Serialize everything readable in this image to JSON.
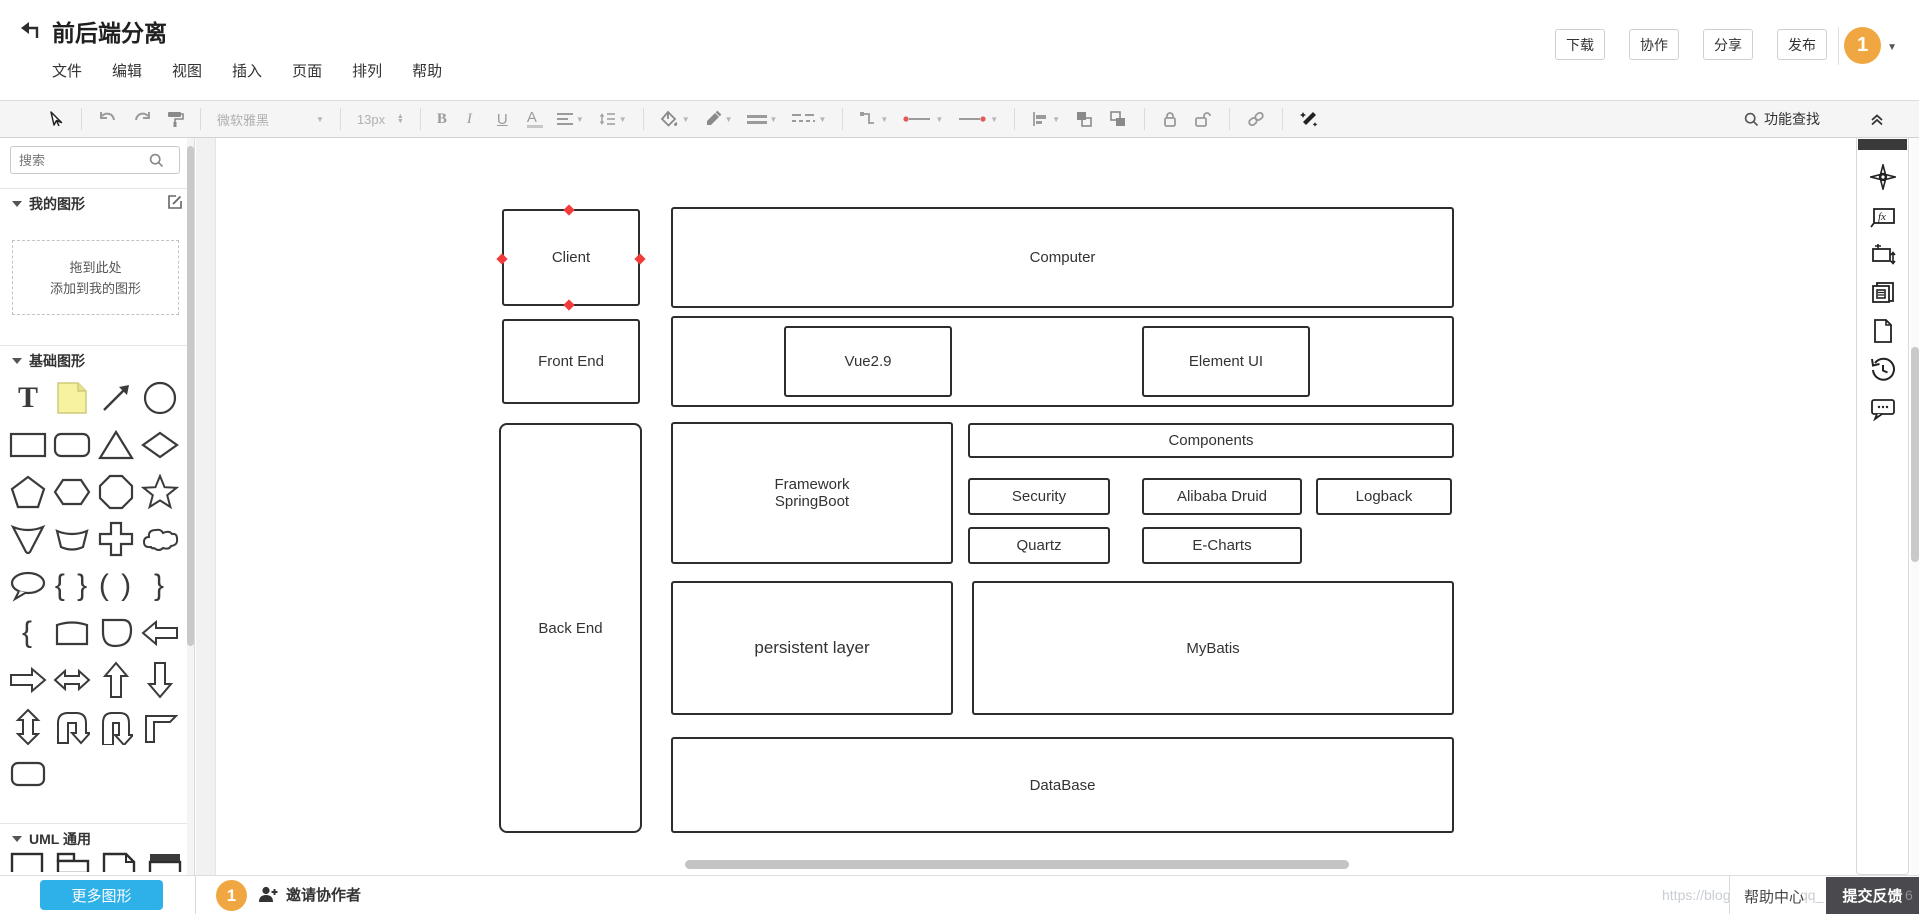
{
  "header": {
    "title": "前后端分离",
    "menus": [
      "文件",
      "编辑",
      "视图",
      "插入",
      "页面",
      "排列",
      "帮助"
    ],
    "actions": [
      "下载",
      "协作",
      "分享",
      "发布"
    ],
    "avatar_label": "1"
  },
  "toolbar": {
    "font_name": "微软雅黑",
    "font_size": "13px",
    "bold": "B",
    "italic": "I",
    "underline": "U",
    "font_color": "A",
    "feature_search": "功能查找"
  },
  "sidebar": {
    "search_placeholder": "搜索",
    "my_shapes_label": "我的图形",
    "drop_hint_line1": "拖到此处",
    "drop_hint_line2": "添加到我的图形",
    "basic_shapes_label": "基础图形",
    "uml_label": "UML 通用",
    "more_shapes_label": "更多图形",
    "glyph_text_tool": "T",
    "glyph_brace_pair": "{ }",
    "glyph_paren_pair": "( )",
    "glyph_right_brace": "}",
    "glyph_left_brace": "{"
  },
  "canvas": {
    "nodes": [
      {
        "label": "Client"
      },
      {
        "label": "Computer"
      },
      {
        "label": "Front End"
      },
      {
        "label": "Vue2.9"
      },
      {
        "label": "Element UI"
      },
      {
        "label": "Back End"
      },
      {
        "label": "Framework\nSpringBoot"
      },
      {
        "label": "Components"
      },
      {
        "label": "Security"
      },
      {
        "label": "Alibaba Druid"
      },
      {
        "label": "Logback"
      },
      {
        "label": "Quartz"
      },
      {
        "label": "E-Charts"
      },
      {
        "label": "persistent layer"
      },
      {
        "label": "MyBatis"
      },
      {
        "label": "DataBase"
      }
    ]
  },
  "right_panel": {
    "fx_label": "fx"
  },
  "footer": {
    "avatar_label": "1",
    "invite_label": "邀请协作者",
    "help_label": "帮助中心",
    "feedback_label": "提交反馈",
    "watermark_fragments": [
      "https://blog",
      "qq_",
      "6"
    ]
  },
  "colors": {
    "accent_blue": "#2eb0e8",
    "avatar_orange": "#f0a742",
    "handle_red": "#f23c3c",
    "feedback_bg": "#4a4a4e",
    "sticky_note_yellow": "#f7f2a0"
  }
}
